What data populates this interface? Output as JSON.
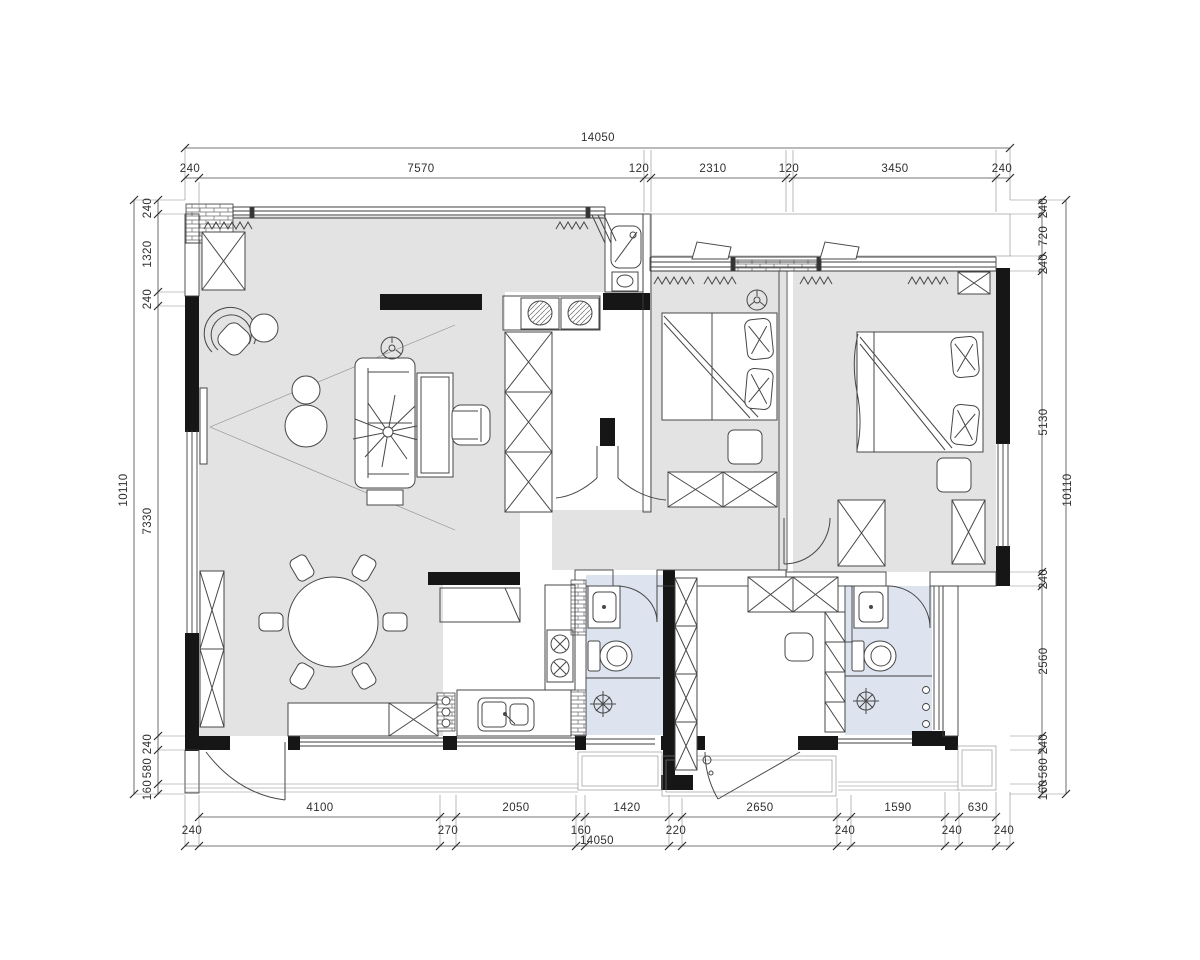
{
  "colors": {
    "floor_gray": "#e3e3e3",
    "bath_blue": "#dde4ef",
    "wall_black": "#161616",
    "line_dark": "#3f3f3f",
    "dim_text": "#2f2f2f"
  },
  "dims": {
    "top": {
      "overall": "14050",
      "segments": [
        "240",
        "7570",
        "120",
        "2310",
        "120",
        "3450",
        "240"
      ]
    },
    "left": {
      "overall": "10110",
      "segments": [
        "240",
        "1320",
        "240",
        "7330",
        "240",
        "580",
        "160"
      ]
    },
    "right": {
      "overall": "10110",
      "segments": [
        "240",
        "720",
        "240",
        "5130",
        "240",
        "2560",
        "240",
        "580",
        "160"
      ]
    },
    "bottom": {
      "overall": "14050",
      "large": [
        "4100",
        "2050",
        "1420",
        "2650",
        "1590",
        "630"
      ],
      "small": [
        "240",
        "270",
        "160",
        "220",
        "240",
        "240",
        "240"
      ]
    }
  }
}
